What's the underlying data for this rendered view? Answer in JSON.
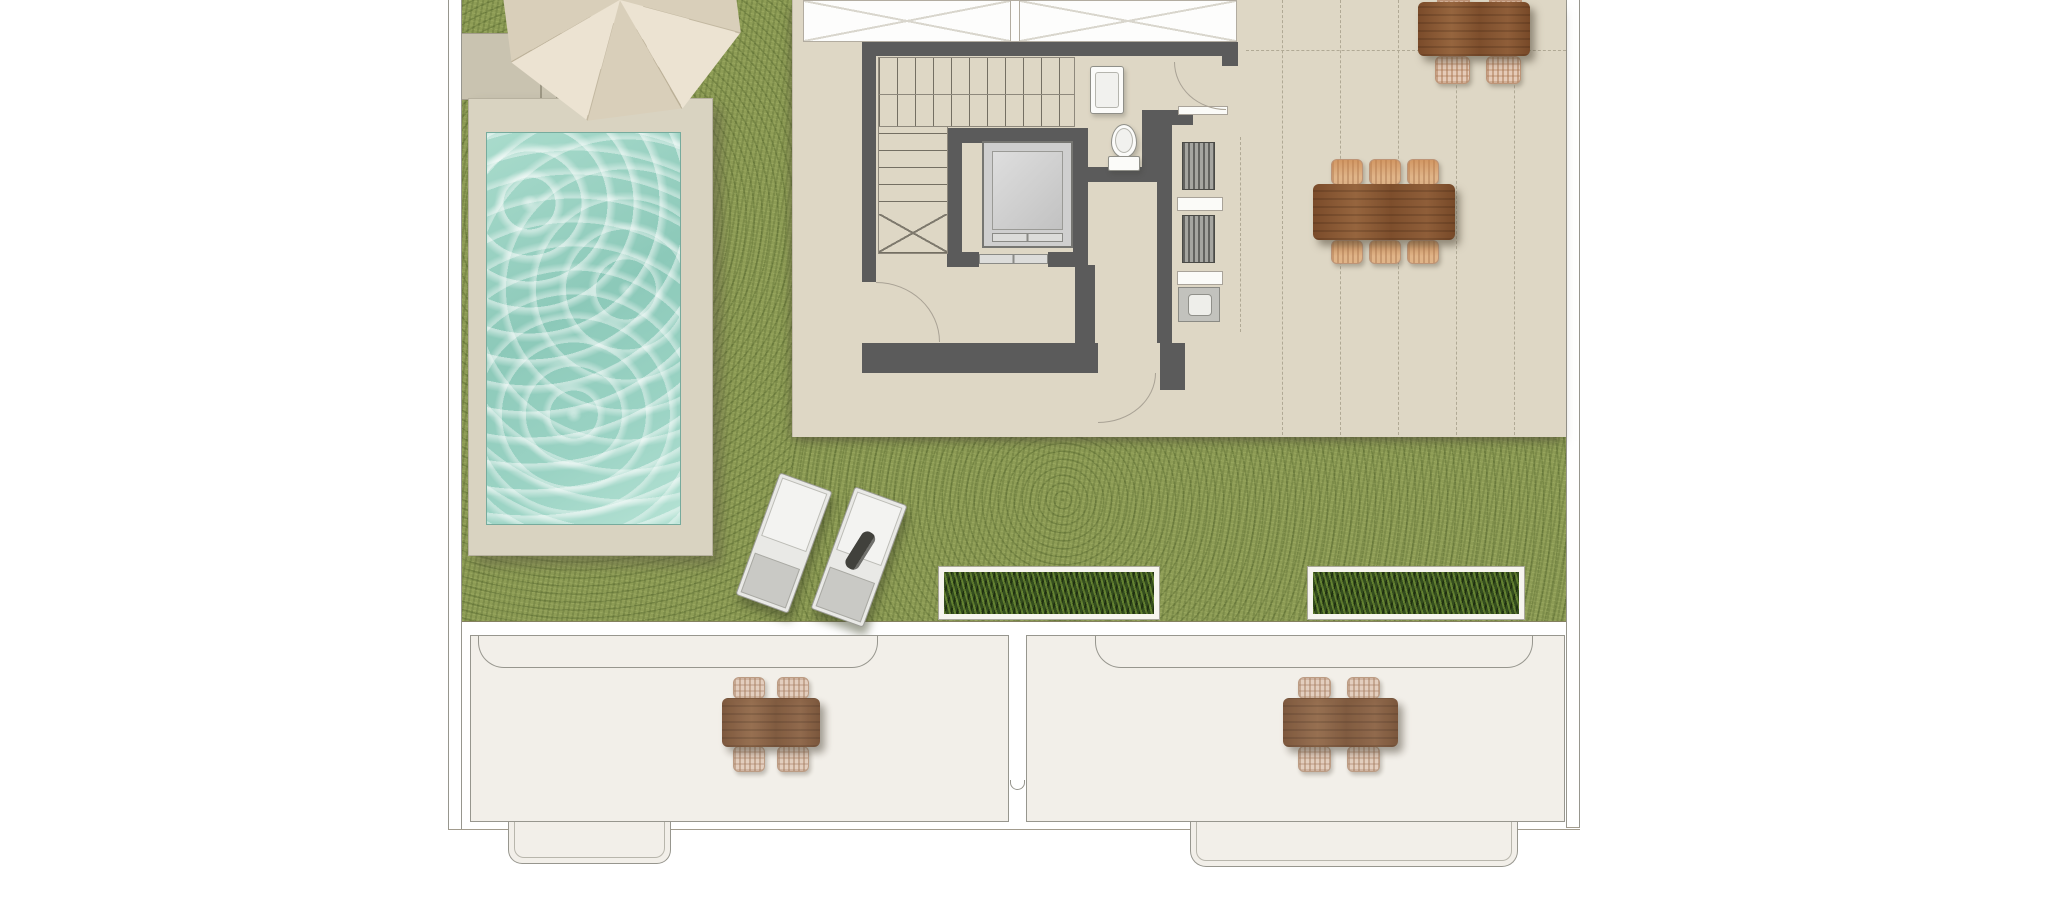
{
  "document": {
    "kind": "architectural-floor-plan",
    "view": "rooftop terrace / solarium level, top-down",
    "visible_text": "none"
  },
  "colors": {
    "page_bg": "#ffffff",
    "line": "#97968e",
    "grass": "#8d9c55",
    "foliage": "#344d1e",
    "water": "#98d0c1",
    "deck": "#d9d3c1",
    "paving": "#c9c3b0",
    "floor": "#ded7c5",
    "wall": "#5b5b5b",
    "white_room": "#fdfdfc",
    "lower_floor": "#f2efe9",
    "wood": "#84532f",
    "wicker": "#e5cbb8",
    "parasol": "#ece3d2",
    "parasol_shade": "#d9cfba",
    "lounger": "#f3f3f1",
    "lounger_foot": "#c9c9c5",
    "cab": "#cfcfcf",
    "fixture": "#fbfbf9",
    "appliance_dark": "#62625f",
    "appliance_light": "#a5a5a0",
    "dash": "#b0a995"
  },
  "areas": {
    "lawn": {
      "surface": "artificial-grass"
    },
    "pool": {
      "shape": "rectangular",
      "surround": "beige deck",
      "water": "turquoise"
    },
    "paved_corner": {
      "steps": true,
      "parasol": true
    },
    "core": {
      "stairs": {
        "flights": 2,
        "break_mark": true
      },
      "elevator": {
        "cab": true,
        "sliding_door": true
      },
      "wc": {
        "toilet": 1,
        "sink": 1,
        "door_arcs": 2
      },
      "kitchenette": {
        "appliances": 2,
        "shelves": 2,
        "sink_unit": 1,
        "open_side_dashed": true
      }
    },
    "pergola_terrace": {
      "dashed_grid_lines_vertical": 5,
      "dashed_grid_lines_horizontal": 1
    },
    "lower_level_outline": {
      "rooms": 2,
      "awnings": 2,
      "entry_steps": 2,
      "downpipe_notch": 1
    }
  },
  "furniture": {
    "parasol": 1,
    "sun_loungers": 2,
    "towel_on_lounger": 1,
    "planter_boxes": 2,
    "dining_sets": [
      {
        "location": "terrace-top-right",
        "table": "wood",
        "chairs_visible": 2
      },
      {
        "location": "terrace-right",
        "table": "wood",
        "chairs_visible": 6
      },
      {
        "location": "lower-room-left",
        "table": "wood",
        "chairs_visible": 4
      },
      {
        "location": "lower-room-right",
        "table": "wood",
        "chairs_visible": 4
      }
    ]
  }
}
